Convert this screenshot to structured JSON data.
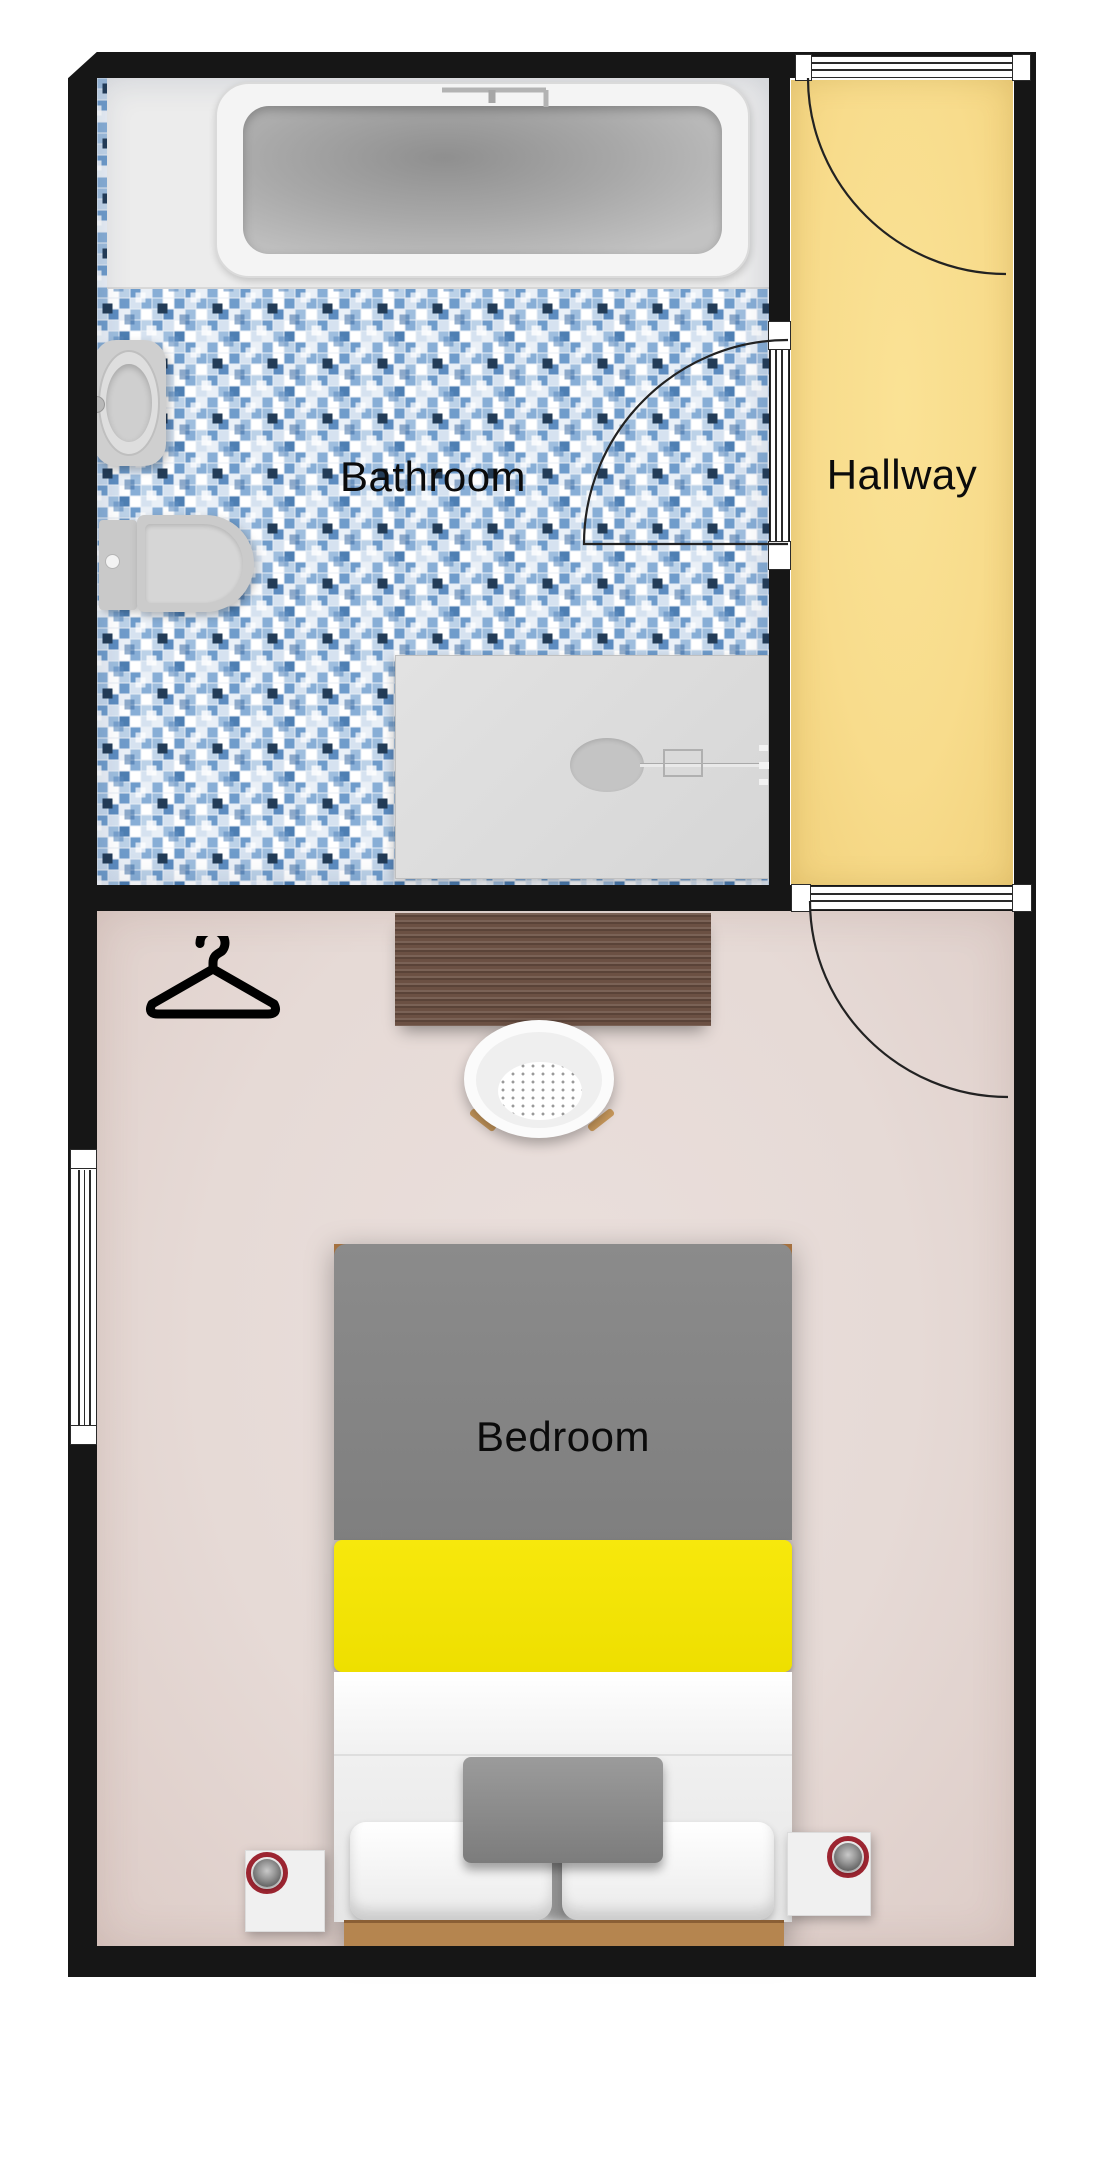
{
  "plan": {
    "type": "floor-plan",
    "rooms": [
      {
        "id": "bathroom",
        "label": "Bathroom",
        "floor": "blue-mosaic-tile"
      },
      {
        "id": "hallway",
        "label": "Hallway",
        "floor": "yellow"
      },
      {
        "id": "bedroom",
        "label": "Bedroom",
        "floor": "pink-beige"
      }
    ],
    "fixtures": {
      "bathroom": [
        "bathtub",
        "bathtub-faucet",
        "pedestal-sink",
        "toilet",
        "shower-tray",
        "shower-drain",
        "shower-arm",
        "bathroom-door"
      ],
      "hallway": [
        "entry-door"
      ],
      "bedroom": [
        "bedroom-door",
        "window",
        "hanger-icon",
        "desk",
        "chair",
        "double-bed",
        "duvet",
        "pillows",
        "nightstand-left",
        "nightstand-right",
        "lamp-left",
        "lamp-right"
      ]
    },
    "colors": {
      "wall": "#161616",
      "bathroom_platform": "#ececec",
      "tile_blue": "#6f9ccb",
      "hallway_floor": "#f8dc8c",
      "bedroom_floor": "#e6dad6",
      "desk_wood": "#6b5043",
      "bed_duvet_gray": "#858585",
      "bed_runner_yellow": "#f2e202",
      "bed_linen_white": "#f5f5f5",
      "bed_frame_wood": "#b5854f",
      "lamp_ring_red": "#9c2531"
    }
  }
}
